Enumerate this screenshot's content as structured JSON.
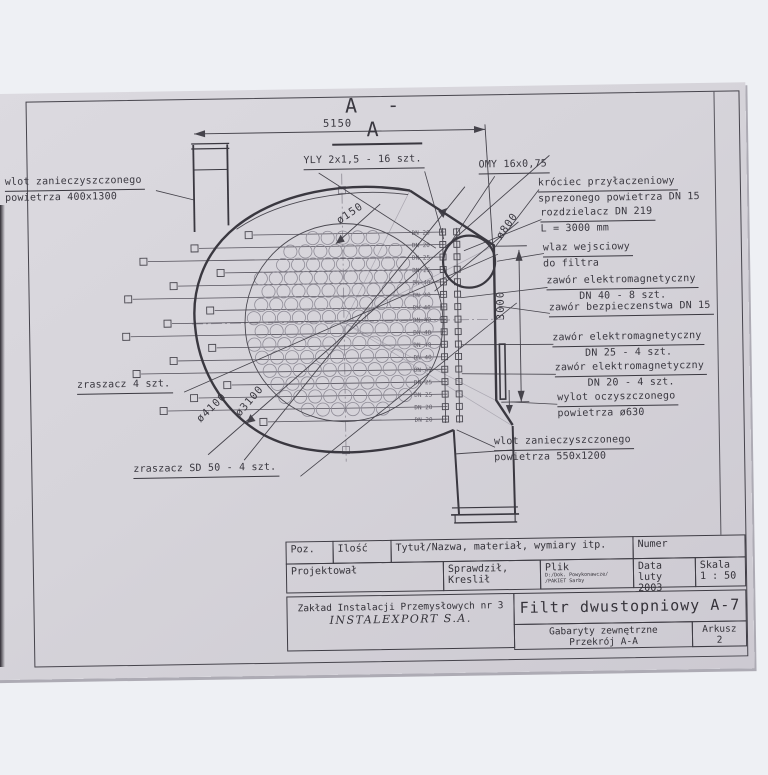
{
  "colors": {
    "paper": "#d6d4da",
    "background": "#eef0f4",
    "ink": "#3a3840"
  },
  "drawing": {
    "section_title": "A - A",
    "dims": {
      "w5150": "5150",
      "h3000": "3000",
      "d150": "ø150",
      "d800": "ø800",
      "d4100": "ø4100",
      "d3100": "ø3100"
    },
    "cables": {
      "yly": "YLY 2x1,5 - 16 szt.",
      "omy": "OMY 16x0,75"
    },
    "labels_left": [
      {
        "id": "inlet-top",
        "lines": [
          "wlot zanieczyszczonego",
          "powietrza 400x1300"
        ]
      },
      {
        "id": "sprayer",
        "lines": [
          "zraszacz 4 szt."
        ]
      },
      {
        "id": "sprayer-sd",
        "lines": [
          "zraszacz SD 50 - 4 szt."
        ]
      }
    ],
    "labels_right": [
      {
        "id": "krociec",
        "lines": [
          "króciec przyłaczeniowy",
          "sprezonego powietrza DN 15"
        ]
      },
      {
        "id": "rozdzielacz",
        "lines": [
          "rozdzielacz DN 219",
          "L = 3000 mm"
        ]
      },
      {
        "id": "wlaz",
        "lines": [
          "wlaz wejsciowy",
          "do filtra"
        ]
      },
      {
        "id": "zawor-dn40",
        "lines": [
          "zawór elektromagnetyczny",
          "DN 40 - 8 szt."
        ]
      },
      {
        "id": "zawor-bezp",
        "lines": [
          "zawór bezpieczenstwa DN 15"
        ]
      },
      {
        "id": "zawor-dn25",
        "lines": [
          "zawór elektromagnetyczny",
          "DN 25 - 4 szt."
        ]
      },
      {
        "id": "zawor-dn20",
        "lines": [
          "zawór elektromagnetyczny",
          "DN 20 - 4 szt."
        ]
      },
      {
        "id": "wylot",
        "lines": [
          "wylot oczyszczonego",
          "powietrza ø630"
        ]
      },
      {
        "id": "inlet-bottom",
        "lines": [
          "wlot zanieczyszczonego",
          "powietrza 550x1200"
        ]
      }
    ],
    "dn_rows": [
      "DN 20",
      "DN 20",
      "DN 25",
      "DN 25",
      "DN 40",
      "DN 40",
      "DN 40",
      "DN 40",
      "DN 40",
      "DN 40",
      "DN 40",
      "DN 40",
      "DN 25",
      "DN 25",
      "DN 20",
      "DN 20"
    ]
  },
  "title_block": {
    "poz": "Poz.",
    "ilosc": "Ilość",
    "tytul": "Tytuł/Nazwa, materiał, wymiary itp.",
    "numer": "Numer",
    "projektowal": "Projektował",
    "sprawdzil": "Sprawdził, Kreslił",
    "plik_label": "Plik",
    "plik_path1": "D:/Dok. Powykonawcze/",
    "plik_path2": "/PAKIET Sarby",
    "data_label": "Data",
    "data_value": "luty 2003",
    "skala_label": "Skala",
    "skala_value": "1 : 50",
    "firma_line1": "Zakład Instalacji Przemysłowych nr 3",
    "firma_line2": "INSTALEXPORT S.A.",
    "drawing_title": "Filtr dwustopniowy A-7",
    "gabaryty_line1": "Gabaryty zewnętrzne",
    "gabaryty_line2": "Przekrój A-A",
    "arkusz_label": "Arkusz",
    "arkusz_value": "2"
  }
}
